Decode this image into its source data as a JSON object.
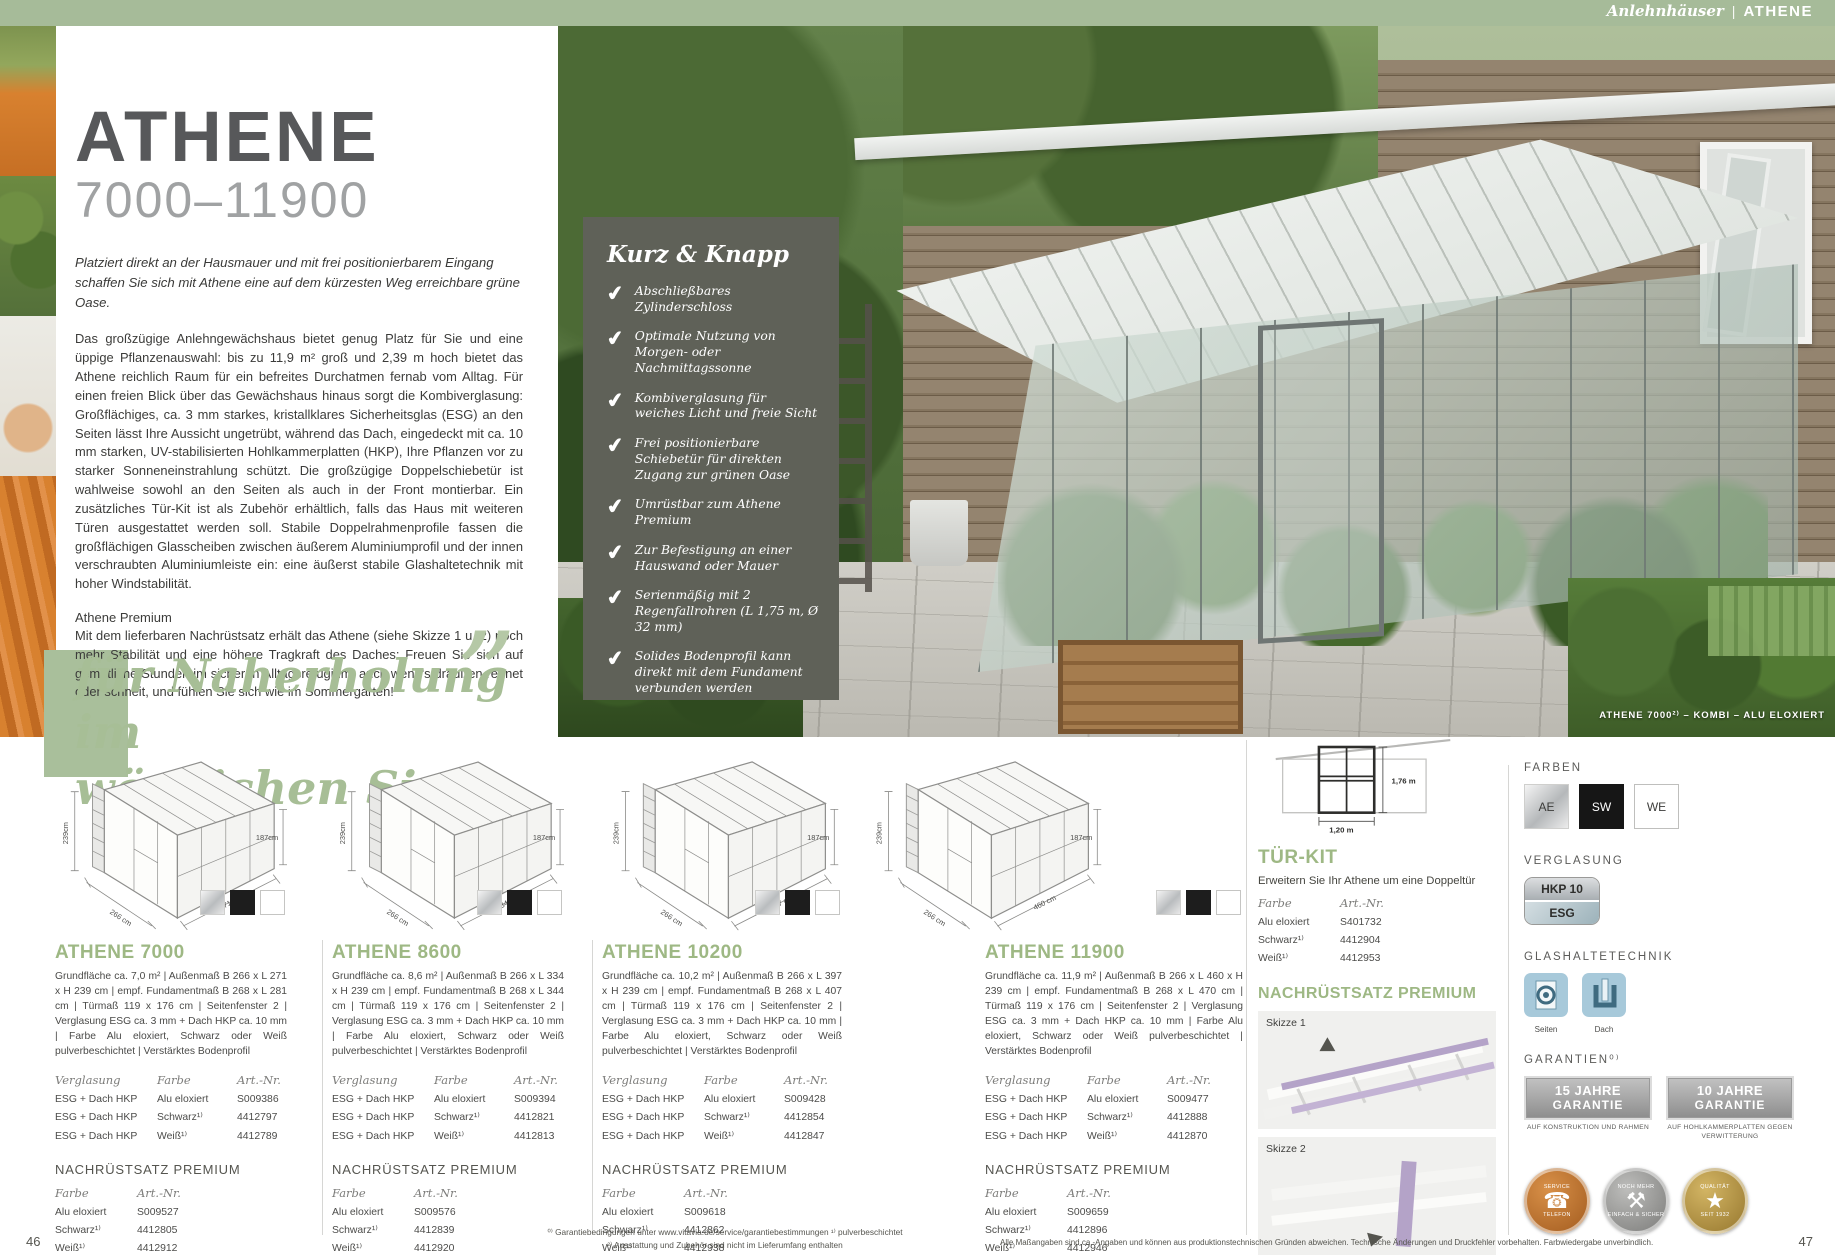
{
  "header": {
    "category": "Anlehnhäuser",
    "separator": "|",
    "product": "ATHENE"
  },
  "hero": {
    "title": "ATHENE",
    "range": "7000–11900",
    "intro": "Platziert direkt an der Hausmauer und mit frei positionierbarem Eingang schaffen Sie sich mit Athene eine auf dem kürzesten Weg erreichbare grüne Oase.",
    "body": "Das großzügige Anlehngewächshaus bietet genug Platz für Sie und eine üppige Pflanzenauswahl: bis zu 11,9 m² groß und 2,39 m hoch bietet das Athene reichlich Raum für ein befreites Durchatmen fernab vom Alltag. Für einen freien Blick über das Gewächshaus hinaus sorgt die Kombiverglasung: Großflächiges, ca. 3 mm starkes, kristallklares Sicherheitsglas (ESG) an den Seiten lässt Ihre Aussicht ungetrübt, während das Dach, eingedeckt mit ca. 10 mm starken, UV-stabilisierten Hohlkammerplatten (HKP), Ihre Pflanzen vor zu starker Sonneneinstrahlung schützt. Die großzügige Doppelschiebetür ist wahlweise sowohl an den Seiten als auch in der Front montierbar. Ein zusätzliches Tür-Kit ist als Zubehör erhältlich, falls das Haus mit weiteren Türen ausgestattet werden soll. Stabile Doppelrahmenprofile fassen die großflächigen Glasscheiben zwischen äußerem Aluminiumprofil und der innen verschraubten Aluminiumleiste ein: eine äußerst stabile Glashaltetechnik mit hoher Windstabilität.",
    "premium_heading": "Athene Premium",
    "premium_body": "Mit dem lieferbaren Nachrüstsatz erhält das Athene (siehe Skizze 1 u. 2) noch mehr Stabilität und eine höhere Tragkraft des Daches: Freuen Sie sich auf gemütliche Stunden im sicheren Alltagsrefugium, auch wenn's draußen regnet oder schneit, und fühlen Sie sich wie im Sommergarten!",
    "quote_line1": "für Naherholung im",
    "quote_line2": "wörtlichen Sinne",
    "quote_mark": "”"
  },
  "kurz_knapp": {
    "title": "Kurz & Knapp",
    "check": "✔",
    "items": [
      "Abschließbares Zylinderschloss",
      "Optimale Nutzung von Morgen- oder Nachmittagssonne",
      "Kombiverglasung für weiches Licht und freie Sicht",
      "Frei positionierbare Schiebetür für direkten Zugang zur grünen Oase",
      "Umrüstbar zum Athene Premium",
      "Zur Befestigung an einer Hauswand oder Mauer",
      "Serienmäßig mit 2 Regenfallrohren (L 1,75 m, Ø 32 mm)",
      "Solides Bodenprofil kann direkt mit dem Fundament verbunden werden"
    ]
  },
  "photo": {
    "caption": "ATHENE 7000²⁾ – KOMBI – ALU ELOXIERT"
  },
  "tables": {
    "col_glazing": "Verglasung",
    "col_color": "Farbe",
    "col_art": "Art.-Nr."
  },
  "products": [
    {
      "name": "ATHENE 7000",
      "desc": "Grundfläche ca. 7,0 m² | Außenmaß B 266 x L 271 x H 239 cm | empf. Fundamentmaß B 268 x L 281 cm | Türmaß 119 x 176 cm | Seitenfenster 2 | Verglasung ESG ca. 3 mm + Dach HKP ca. 10 mm | Farbe Alu eloxiert, Schwarz oder Weiß pulverbeschichtet | Verstärktes Bodenprofil",
      "dims": {
        "wall_height": "239cm",
        "front_height": "187cm",
        "width": "266 cm",
        "length": "271 cm"
      },
      "rows": [
        {
          "g": "ESG + Dach HKP",
          "c": "Alu eloxiert",
          "a": "S009386"
        },
        {
          "g": "ESG + Dach HKP",
          "c": "Schwarz¹⁾",
          "a": "4412797"
        },
        {
          "g": "ESG + Dach HKP",
          "c": "Weiß¹⁾",
          "a": "4412789"
        }
      ],
      "retrofit_title": "NACHRÜSTSATZ PREMIUM",
      "retrofit_rows": [
        {
          "c": "Alu eloxiert",
          "a": "S009527"
        },
        {
          "c": "Schwarz¹⁾",
          "a": "4412805"
        },
        {
          "c": "Weiß¹⁾",
          "a": "4412912"
        }
      ]
    },
    {
      "name": "ATHENE 8600",
      "desc": "Grundfläche ca. 8,6 m² | Außenmaß B 266 x L 334 x H 239 cm | empf. Fundamentmaß B 268 x L 344 cm | Türmaß 119 x 176 cm | Seitenfenster 2 | Verglasung ESG ca. 3 mm + Dach HKP ca. 10 mm | Farbe Alu eloxiert, Schwarz oder Weiß pulverbeschichtet | Verstärktes Bodenprofil",
      "dims": {
        "wall_height": "239cm",
        "front_height": "187cm",
        "width": "266 cm",
        "length": "334 cm"
      },
      "rows": [
        {
          "g": "ESG + Dach HKP",
          "c": "Alu eloxiert",
          "a": "S009394"
        },
        {
          "g": "ESG + Dach HKP",
          "c": "Schwarz¹⁾",
          "a": "4412821"
        },
        {
          "g": "ESG + Dach HKP",
          "c": "Weiß¹⁾",
          "a": "4412813"
        }
      ],
      "retrofit_title": "NACHRÜSTSATZ PREMIUM",
      "retrofit_rows": [
        {
          "c": "Alu eloxiert",
          "a": "S009576"
        },
        {
          "c": "Schwarz¹⁾",
          "a": "4412839"
        },
        {
          "c": "Weiß¹⁾",
          "a": "4412920"
        }
      ]
    },
    {
      "name": "ATHENE 10200",
      "desc": "Grundfläche ca. 10,2 m² | Außenmaß B 266 x L 397 x H 239 cm | empf. Fundamentmaß B 268 x L 407 cm | Türmaß 119 x 176 cm | Seitenfenster 2 | Verglasung ESG ca. 3 mm + Dach HKP ca. 10 mm | Farbe Alu eloxiert, Schwarz oder Weiß pulverbeschichtet | Verstärktes Bodenprofil",
      "dims": {
        "wall_height": "239cm",
        "front_height": "187cm",
        "width": "266 cm",
        "length": "397 cm"
      },
      "rows": [
        {
          "g": "ESG + Dach HKP",
          "c": "Alu eloxiert",
          "a": "S009428"
        },
        {
          "g": "ESG + Dach HKP",
          "c": "Schwarz¹⁾",
          "a": "4412854"
        },
        {
          "g": "ESG + Dach HKP",
          "c": "Weiß¹⁾",
          "a": "4412847"
        }
      ],
      "retrofit_title": "NACHRÜSTSATZ PREMIUM",
      "retrofit_rows": [
        {
          "c": "Alu eloxiert",
          "a": "S009618"
        },
        {
          "c": "Schwarz¹⁾",
          "a": "4412862"
        },
        {
          "c": "Weiß¹⁾",
          "a": "4412938"
        }
      ]
    },
    {
      "name": "ATHENE 11900",
      "desc": "Grundfläche ca. 11,9 m² | Außenmaß B 266 x L 460 x H 239 cm | empf. Fundamentmaß B 268 x L 470 cm | Türmaß 119 x 176 cm | Seitenfenster 2 | Verglasung ESG ca. 3 mm + Dach HKP ca. 10 mm | Farbe Alu eloxiert, Schwarz oder Weiß pulverbeschichtet | Verstärktes Bodenprofil",
      "dims": {
        "wall_height": "239cm",
        "front_height": "187cm",
        "width": "266 cm",
        "length": "460 cm"
      },
      "rows": [
        {
          "g": "ESG + Dach HKP",
          "c": "Alu eloxiert",
          "a": "S009477"
        },
        {
          "g": "ESG + Dach HKP",
          "c": "Schwarz¹⁾",
          "a": "4412888"
        },
        {
          "g": "ESG + Dach HKP",
          "c": "Weiß¹⁾",
          "a": "4412870"
        }
      ],
      "retrofit_title": "NACHRÜSTSATZ PREMIUM",
      "retrofit_rows": [
        {
          "c": "Alu eloxiert",
          "a": "S009659"
        },
        {
          "c": "Schwarz¹⁾",
          "a": "4412896"
        },
        {
          "c": "Weiß¹⁾",
          "a": "4412946"
        }
      ]
    }
  ],
  "tuerkit": {
    "title": "TÜR-KIT",
    "subtitle": "Erweitern Sie Ihr Athene um eine Doppeltür",
    "door_height": "1,76 m",
    "door_width": "1,20 m",
    "rows": [
      {
        "c": "Alu eloxiert",
        "a": "S401732"
      },
      {
        "c": "Schwarz¹⁾",
        "a": "4412904"
      },
      {
        "c": "Weiß¹⁾",
        "a": "4412953"
      }
    ],
    "retrofit_title": "NACHRÜSTSATZ PREMIUM",
    "skizze1": "Skizze 1",
    "skizze2": "Skizze 2"
  },
  "sidebar": {
    "farben_title": "FARBEN",
    "farben": [
      {
        "code": "AE"
      },
      {
        "code": "SW"
      },
      {
        "code": "WE"
      }
    ],
    "verglasung_title": "VERGLASUNG",
    "verglasung_top": "HKP 10",
    "verglasung_bottom": "ESG",
    "glas_title": "GLASHALTETECHNIK",
    "glas_labels": [
      "Seiten",
      "Dach"
    ],
    "garantien_title": "GARANTIEN⁰⁾",
    "warranties": [
      {
        "years": "15 JAHRE",
        "word": "GARANTIE",
        "sub": "AUF KONSTRUKTION UND RAHMEN"
      },
      {
        "years": "10 JAHRE",
        "word": "GARANTIE",
        "sub": "AUF HOHLKAMMERPLATTEN GEGEN VERWITTERUNG"
      }
    ],
    "badges": [
      {
        "top": "SERVICE",
        "bottom": "TELEFON",
        "icon": "☎"
      },
      {
        "top": "NOCH MEHR",
        "bottom": "EINFACH & SICHER",
        "icon": "⚒"
      },
      {
        "top": "QUALITÄT",
        "bottom": "SEIT 1932",
        "icon": "★"
      }
    ]
  },
  "footer": {
    "page_left": "46",
    "page_right": "47",
    "note1": "⁰⁾ Garantiebedingungen unter www.vitavia.de/service/garantiebestimmungen    ¹⁾ pulverbeschichtet",
    "note2": "²⁾ Ausstattung und Zubehör sind nicht im Lieferumfang enthalten",
    "disclaimer": "Alle Maßangaben sind ca.-Angaben und können aus produktionstechnischen Gründen abweichen. Technische Änderungen und Druckfehler vorbehalten. Farbwiedergabe unverbindlich."
  }
}
